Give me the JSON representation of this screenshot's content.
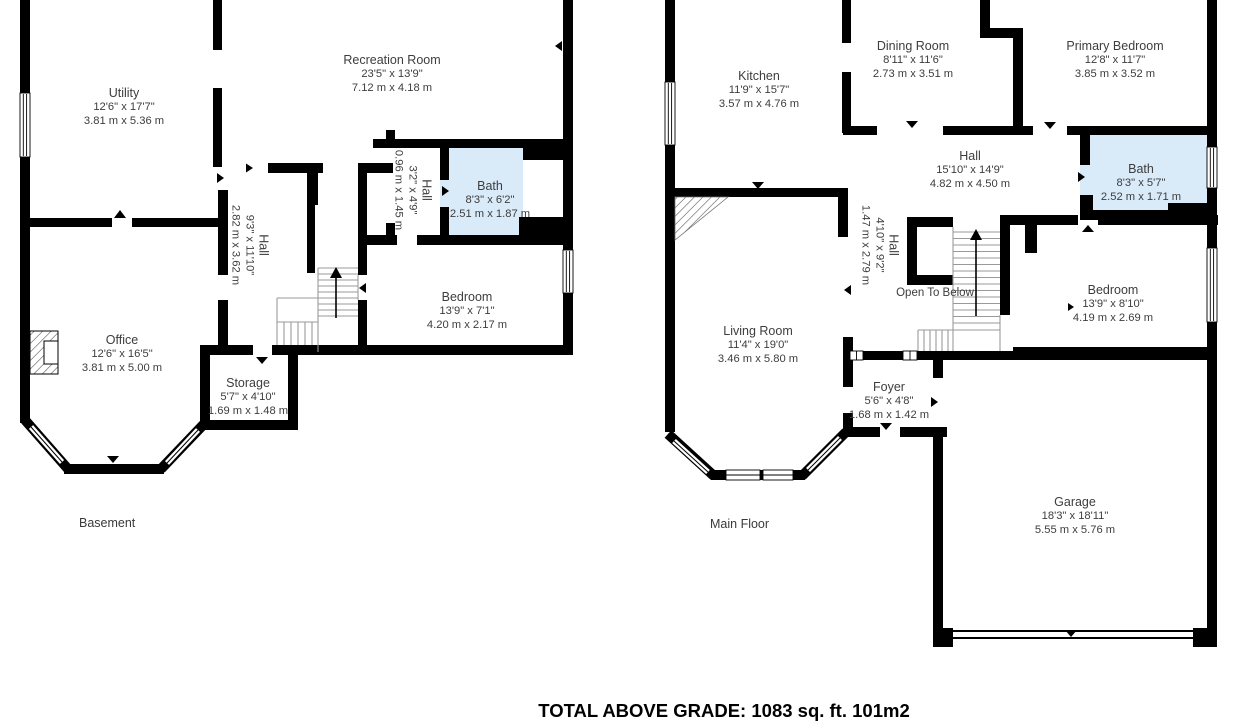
{
  "colors": {
    "wall": "#000000",
    "bath_fill": "#d9eaf8",
    "text": "#3d3d3d",
    "stair_line": "#9a9a9a"
  },
  "footer": {
    "total_label": "TOTAL ABOVE GRADE: 1083 sq. ft. 101m2"
  },
  "floors": [
    {
      "label": "Basement",
      "rooms": [
        {
          "name": "Utility",
          "imperial": "12'6\" x 17'7\"",
          "metric": "3.81 m x 5.36 m"
        },
        {
          "name": "Recreation Room",
          "imperial": "23'5\" x 13'9\"",
          "metric": "7.12 m x 4.18 m"
        },
        {
          "name": "Hall",
          "imperial": "3'2\" x 4'9\"",
          "metric": "0.96 m x 1.45 m",
          "rotated": true
        },
        {
          "name": "Bath",
          "imperial": "8'3\" x 6'2\"",
          "metric": "2.51 m x 1.87 m"
        },
        {
          "name": "Hall",
          "imperial": "9'3\" x 11'10\"",
          "metric": "2.82 m x 3.62 m",
          "rotated": true
        },
        {
          "name": "Bedroom",
          "imperial": "13'9\" x 7'1\"",
          "metric": "4.20 m x 2.17 m"
        },
        {
          "name": "Office",
          "imperial": "12'6\" x 16'5\"",
          "metric": "3.81 m x 5.00 m"
        },
        {
          "name": "Storage",
          "imperial": "5'7\" x 4'10\"",
          "metric": "1.69 m x 1.48 m"
        }
      ]
    },
    {
      "label": "Main Floor",
      "rooms": [
        {
          "name": "Kitchen",
          "imperial": "11'9\" x 15'7\"",
          "metric": "3.57 m x 4.76 m"
        },
        {
          "name": "Dining Room",
          "imperial": "8'11\" x 11'6\"",
          "metric": "2.73 m x 3.51 m"
        },
        {
          "name": "Primary Bedroom",
          "imperial": "12'8\" x 11'7\"",
          "metric": "3.85 m x 3.52 m"
        },
        {
          "name": "Hall",
          "imperial": "15'10\" x 14'9\"",
          "metric": "4.82 m x 4.50 m"
        },
        {
          "name": "Bath",
          "imperial": "8'3\" x 5'7\"",
          "metric": "2.52 m x 1.71 m"
        },
        {
          "name": "Hall",
          "imperial": "4'10\" x 9'2\"",
          "metric": "1.47 m x 2.79 m",
          "rotated": true
        },
        {
          "name": "Open To Below"
        },
        {
          "name": "Bedroom",
          "imperial": "13'9\" x 8'10\"",
          "metric": "4.19 m x 2.69 m"
        },
        {
          "name": "Living Room",
          "imperial": "11'4\" x 19'0\"",
          "metric": "3.46 m x 5.80 m"
        },
        {
          "name": "Foyer",
          "imperial": "5'6\" x 4'8\"",
          "metric": "1.68 m x 1.42 m"
        },
        {
          "name": "Garage",
          "imperial": "18'3\" x 18'11\"",
          "metric": "5.55 m x 5.76 m"
        }
      ]
    }
  ]
}
